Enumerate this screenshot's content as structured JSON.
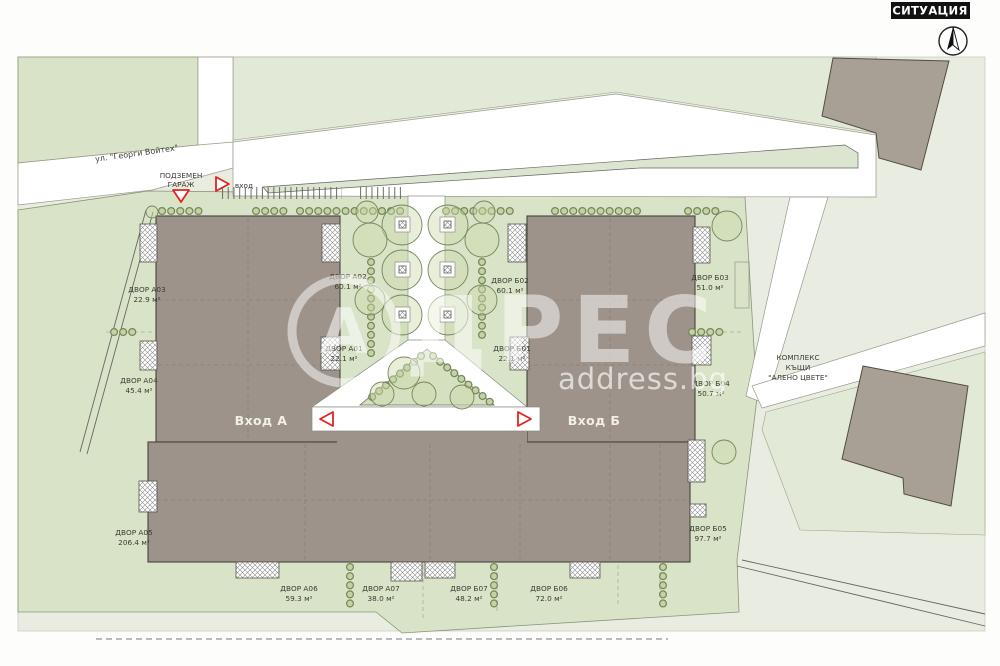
{
  "header": {
    "title": "СИТУАЦИЯ"
  },
  "map": {
    "street_label": "ул. \"Георги Войтех\"",
    "garage_label_1": "ПОДЗЕМЕН",
    "garage_label_2": "ГАРАЖ",
    "entry_label": "вход",
    "entrance_a": "Вход А",
    "entrance_b": "Вход Б",
    "complex_label_1": "КОМПЛЕКС",
    "complex_label_2": "КЪЩИ",
    "complex_label_3": "\"АЛЕНО ЦВЕТЕ\"",
    "courtyards": [
      {
        "name": "ДВОР А03",
        "area": "22.9 м²"
      },
      {
        "name": "ДВОР А04",
        "area": "45.4 м²"
      },
      {
        "name": "ДВОР А05",
        "area": "206.4 м²"
      },
      {
        "name": "ДВОР А06",
        "area": "59.3 м²"
      },
      {
        "name": "ДВОР А07",
        "area": "38.0 м²"
      },
      {
        "name": "ДВОР Б07",
        "area": "48.2 м²"
      },
      {
        "name": "ДВОР Б06",
        "area": "72.0 м²"
      },
      {
        "name": "ДВОР Б05",
        "area": "97.7 м²"
      },
      {
        "name": "ДВОР Б04",
        "area": "50.7 м²"
      },
      {
        "name": "ДВОР Б03",
        "area": "51.0 м²"
      },
      {
        "name": "ДВОР Б02",
        "area": "60.1 м²"
      },
      {
        "name": "ДВОР А02",
        "area": "60.1 м²"
      },
      {
        "name": "ДВОР А01",
        "area": "22.1 м²"
      },
      {
        "name": "ДВОР Б01",
        "area": "22.1 м²"
      }
    ]
  },
  "watermark": {
    "letter": "А",
    "rest": "ДРЕС",
    "domain": "address.bg"
  },
  "colors": {
    "site_green": "#d8e3c7",
    "building": "#9d938a",
    "accent_red": "#e3231e",
    "context": "#e9ece1"
  }
}
